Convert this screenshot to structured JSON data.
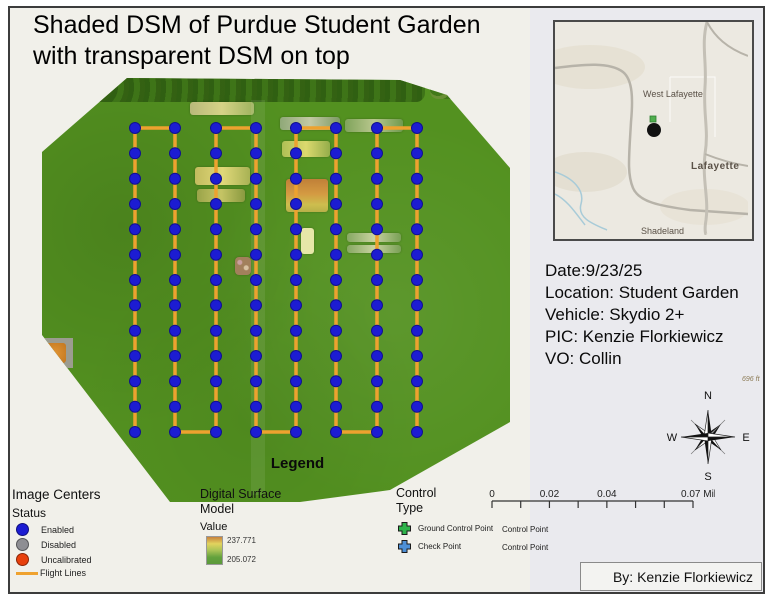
{
  "title": {
    "line1": "Shaded DSM of Purdue Student Garden",
    "line2": "with transparent DSM on top"
  },
  "inset_map": {
    "city_top": "West Lafayette",
    "city_right": "Lafayette",
    "city_bottom": "Shadeland",
    "marker_color": "#111111",
    "marker_square_color": "#4fae4e"
  },
  "info": {
    "date": "Date:9/23/25",
    "location": "Location: Student Garden",
    "vehicle": "Vehicle: Skydio 2+",
    "pic": "PIC: Kenzie Florkiewicz",
    "vo": "VO: Collin"
  },
  "elevation_label": "696 ft",
  "compass": {
    "n": "N",
    "e": "E",
    "s": "S",
    "w": "W"
  },
  "scale_bar": {
    "ticks": 8,
    "labels": [
      {
        "text": "0",
        "tick": 0
      },
      {
        "text": "0.02",
        "tick": 2
      },
      {
        "text": "0.04",
        "tick": 4
      },
      {
        "text": "0.07 Miles",
        "tick": 7
      }
    ]
  },
  "legend": {
    "title": "Legend",
    "image_centers": {
      "header": "Image Centers",
      "subheader": "Status",
      "items": [
        {
          "label": "Enabled",
          "color": "#1c1cd2",
          "shape": "circle"
        },
        {
          "label": "Disabled",
          "color": "#8e8e93",
          "shape": "circle"
        },
        {
          "label": "Uncalibrated",
          "color": "#e8400c",
          "shape": "circle"
        },
        {
          "label": "Flight Lines",
          "color": "#efa22f",
          "shape": "line"
        }
      ]
    },
    "dsm": {
      "header_line1": "Digital Surface",
      "header_line2": "Model",
      "subheader": "Value",
      "max": "237.771",
      "min": "205.072",
      "ramp": [
        "#c8823c",
        "#e2d35e",
        "#a9c356",
        "#63a23d",
        "#5b993a"
      ]
    },
    "control": {
      "header_line1": "Control",
      "header_line2": "Type",
      "items": [
        {
          "label": "Ground Control Point",
          "type_label": "Control Point",
          "color": "#2db34a"
        },
        {
          "label": "Check Point",
          "type_label": "Control Point",
          "color": "#4d8fd6"
        }
      ]
    }
  },
  "byline": "By: Kenzie Florkiewicz",
  "map": {
    "flight_path": {
      "columns_x": [
        135,
        175,
        216,
        256,
        296,
        336,
        377,
        417
      ],
      "y_top": 128,
      "y_bottom": 432,
      "dots_per_column": 13,
      "top_links": [
        [
          0,
          1
        ],
        [
          2,
          3
        ],
        [
          4,
          5
        ],
        [
          6,
          7
        ]
      ],
      "bottom_links": [
        [
          1,
          2
        ],
        [
          3,
          4
        ],
        [
          5,
          6
        ]
      ],
      "dot_color": "#1c1cd2",
      "dot_stroke": "#10108f",
      "dot_radius": 5.5,
      "line_color": "#eda22f",
      "line_width": 3.5
    },
    "base_color": "#539120"
  }
}
